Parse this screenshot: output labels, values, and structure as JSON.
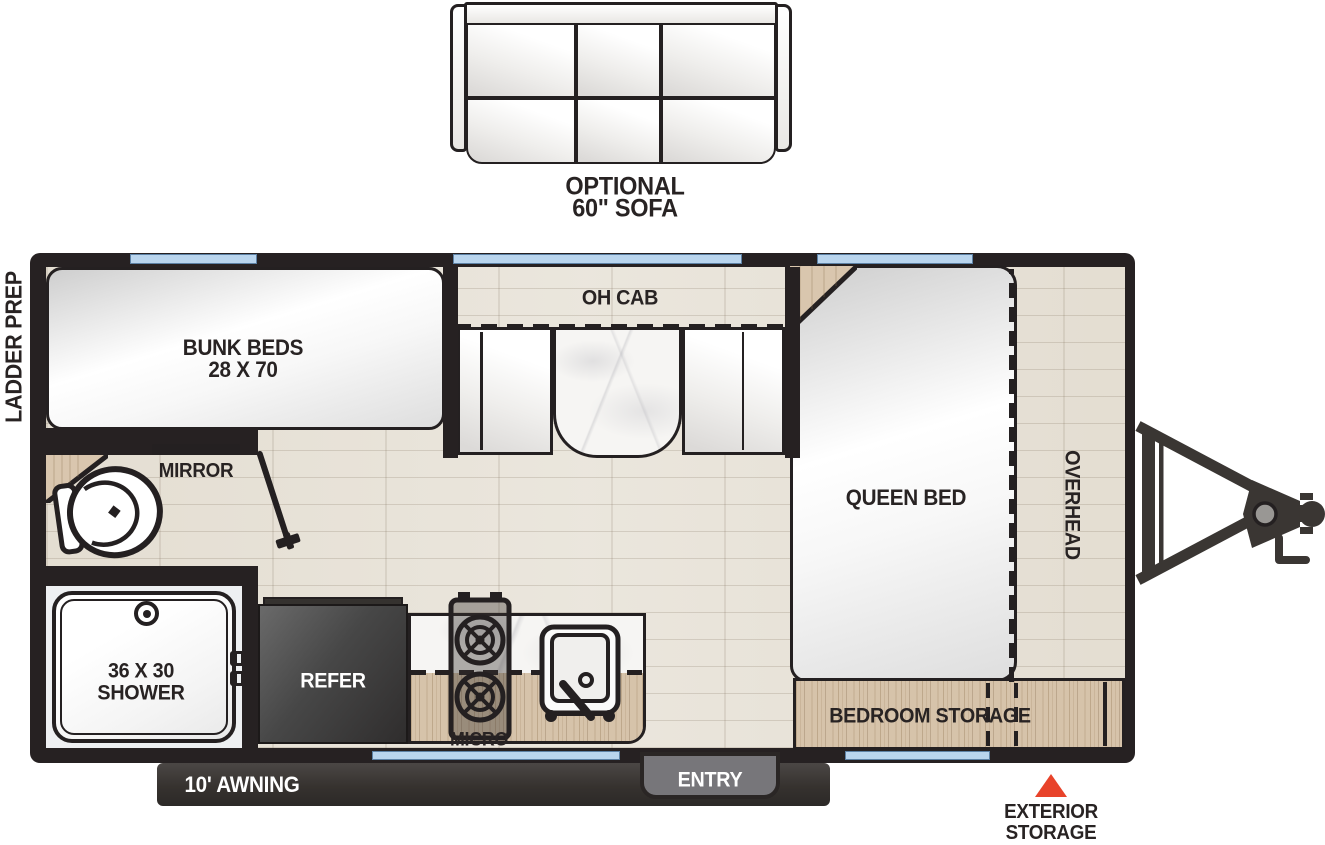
{
  "diagram": {
    "type": "rv-travel-trailer-floorplan",
    "exterior_left_label": "LADDER PREP",
    "sofa": {
      "line1": "OPTIONAL",
      "line2": "60\" SOFA"
    },
    "rooms": {
      "bunk": {
        "line1": "BUNK BEDS",
        "line2": "28 X 70"
      },
      "oh_cab": "OH CAB",
      "mirror": "MIRROR",
      "shower": {
        "line1": "36 X 30",
        "line2": "SHOWER"
      },
      "refer": "REFER",
      "micro": "MICRO",
      "queen_bed": "QUEEN BED",
      "overhead": "OVERHEAD",
      "bedroom_storage": "BEDROOM STORAGE"
    },
    "exterior": {
      "awning": "10' AWNING",
      "entry": "ENTRY",
      "storage_line1": "EXTERIOR",
      "storage_line2": "STORAGE"
    },
    "fixtures": [
      "toilet-icon",
      "shower-drain-icon",
      "door-swing-icon",
      "stove-burners-icon",
      "sink-icon",
      "tongue-hitch-icon",
      "window-strip",
      "corner-shelf"
    ],
    "colors": {
      "wall": "#262122",
      "cabinet_wood": "#d6c3aa",
      "floor": "#e9e4da",
      "window": "#b9d5ee",
      "accent_triangle": "#e8432a",
      "refrigerator": "#474747",
      "awning_bar": "#36322f",
      "entry_gray": "#77767a",
      "label_text": "#282323"
    }
  }
}
